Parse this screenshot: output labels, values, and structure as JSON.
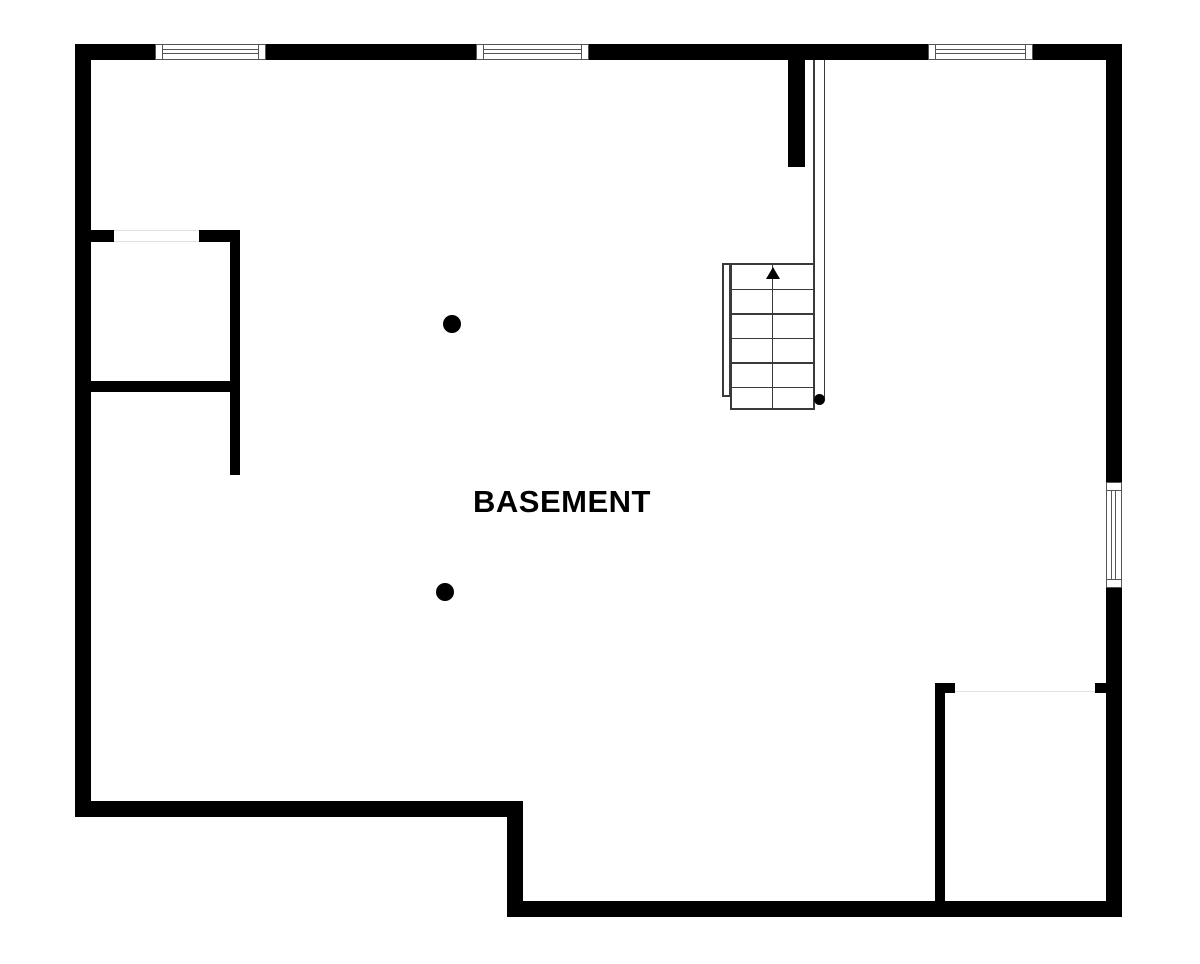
{
  "page": {
    "background": "#ffffff",
    "width": 1200,
    "height": 964
  },
  "floorplan": {
    "label": "BASEMENT",
    "colors": {
      "wall": "#000000",
      "floor": "#ffffff",
      "thin-line": "#3a3a3a",
      "window-border": "#555555",
      "opening-line": "#e2e2e2"
    },
    "stairs": {
      "steps": 6,
      "direction": "up"
    },
    "counts": {
      "columns": 2,
      "top_windows": 3,
      "right_windows": 1
    }
  }
}
